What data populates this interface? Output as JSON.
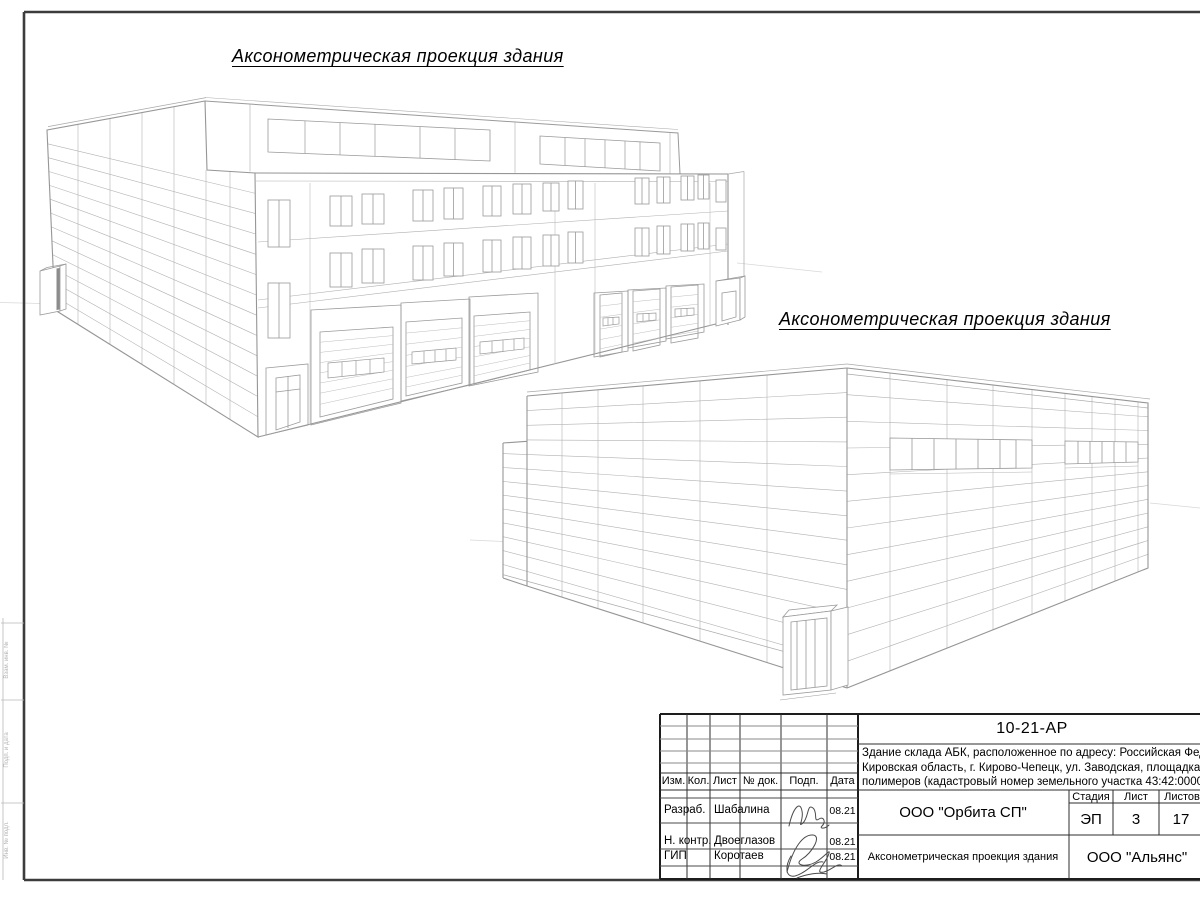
{
  "view_titles": {
    "first": "Аксонометрическая проекция здания",
    "second": "Аксонометрическая проекция здания"
  },
  "title_block": {
    "doc_number": "10-21-АР",
    "description_line1": "Здание склада АБК, расположенное по адресу: Российская Федерация,",
    "description_line2": "Кировская область, г. Кирово-Чепецк, ул. Заводская, площадка завода",
    "description_line3": "полимеров (кадастровый номер земельного участка 43:42:000022:",
    "columns": {
      "izm": "Изм.",
      "kol": "Кол.",
      "list": "Лист",
      "doc": "№ док.",
      "podp": "Подп.",
      "data": "Дата"
    },
    "rows": {
      "r1_role": "Разраб.",
      "r1_name": "Шабалина",
      "r1_date": "08.21",
      "r2_role": "Н. контр.",
      "r2_name": "Двоеглазов",
      "r2_date": "08.21",
      "r3_role": "ГИП",
      "r3_name": "Коротаев",
      "r3_date": "08.21"
    },
    "design_org": "ООО \"Орбита СП\"",
    "stage_label": "Стадия",
    "sheet_label": "Лист",
    "sheets_label": "Листов",
    "stage": "ЭП",
    "sheet_number": "3",
    "sheets_total": "17",
    "drawing_name": "Аксонометрическая проекция здания",
    "contractor_org": "ООО \"Альянс\""
  },
  "margin": {
    "label_top": "Взам. инв. №",
    "label_mid": "Подп. и дата",
    "label_bottom": "Инв. № подл."
  }
}
